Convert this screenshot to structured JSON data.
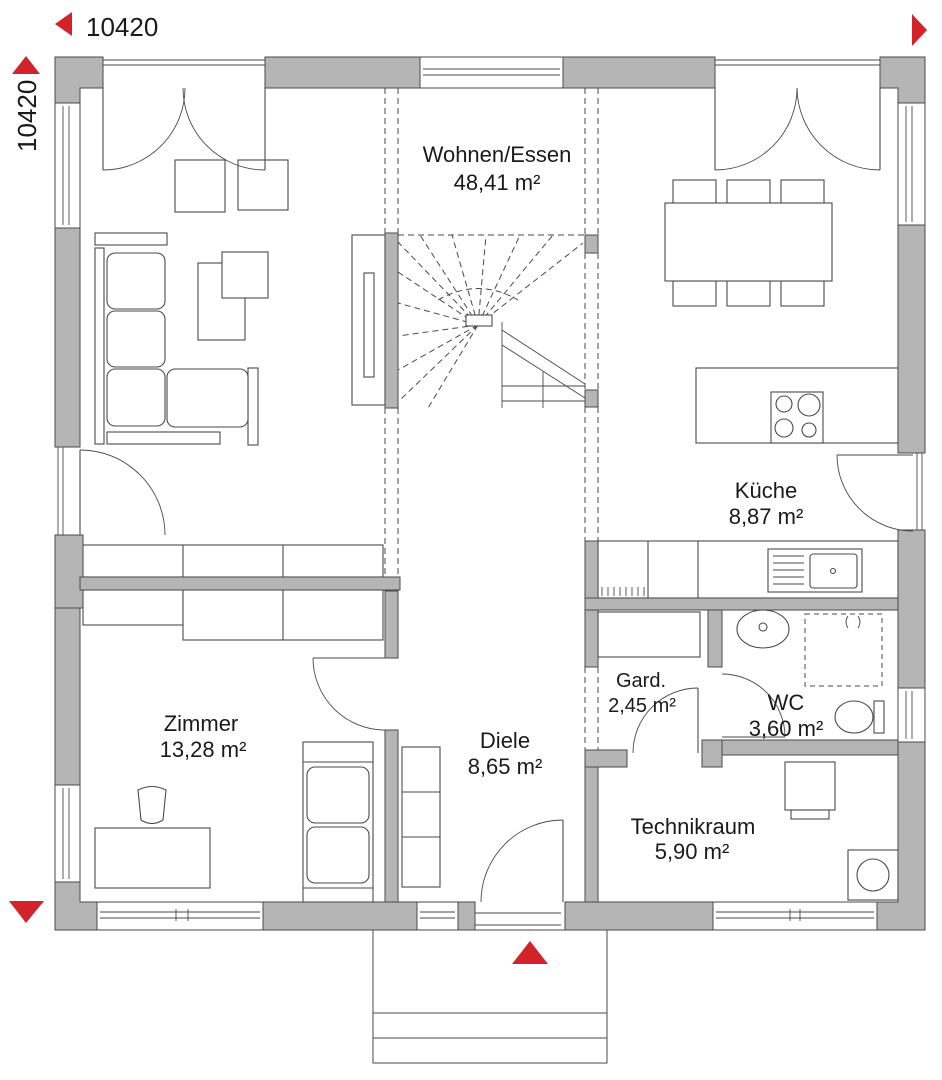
{
  "plan": {
    "type": "floor-plan",
    "dimensions": {
      "width_label": "10420",
      "height_label": "10420"
    },
    "rooms": [
      {
        "name": "Wohnen/Essen",
        "area": "48,41 m²"
      },
      {
        "name": "Küche",
        "area": "8,87 m²"
      },
      {
        "name": "Zimmer",
        "area": "13,28 m²"
      },
      {
        "name": "Diele",
        "area": "8,65 m²"
      },
      {
        "name": "Gard.",
        "area": "2,45 m²"
      },
      {
        "name": "WC",
        "area": "3,60 m²"
      },
      {
        "name": "Technikraum",
        "area": "5,90 m²"
      }
    ]
  },
  "colors": {
    "wall": "#b5b5b5",
    "line": "#4a4a4a",
    "text": "#1a1a1a",
    "accent_red": "#d2232a"
  }
}
